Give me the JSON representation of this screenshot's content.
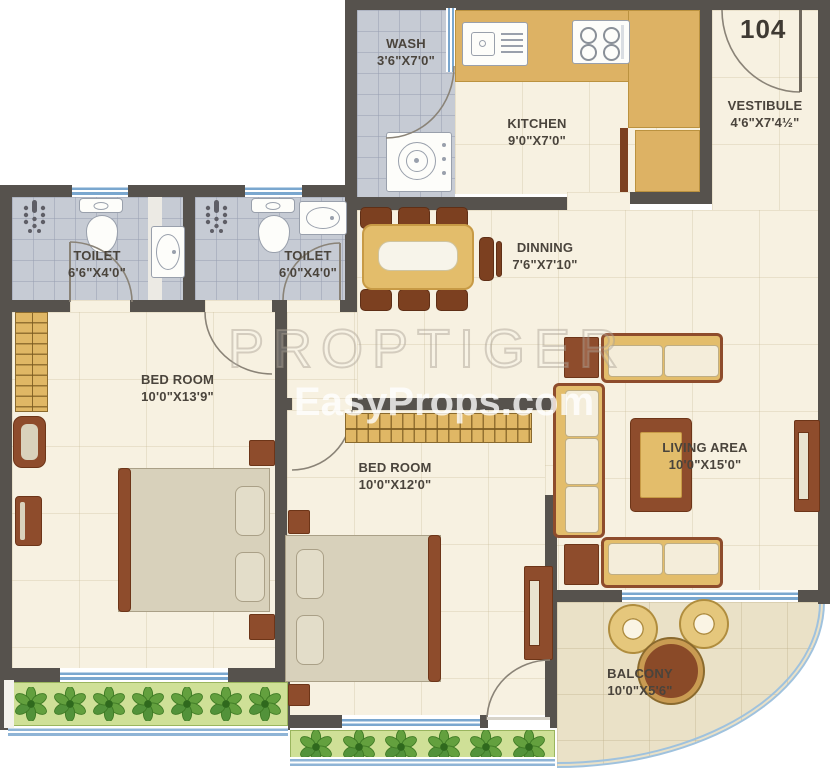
{
  "unit_number": "104",
  "watermarks": {
    "primary": "PROPTIGER",
    "secondary": "EasyProps.com"
  },
  "rooms": {
    "wash": {
      "name": "WASH",
      "dims": "3'6\"X7'0\""
    },
    "kitchen": {
      "name": "KITCHEN",
      "dims": "9'0\"X7'0\""
    },
    "vestibule": {
      "name": "VESTIBULE",
      "dims": "4'6\"X7'4½\""
    },
    "toilet_left": {
      "name": "TOILET",
      "dims": "6'6\"X4'0\""
    },
    "toilet_mid": {
      "name": "TOILET",
      "dims": "6'0\"X4'0\""
    },
    "dining": {
      "name": "DINNING",
      "dims": "7'6\"X7'10\""
    },
    "bedroom_left": {
      "name": "BED ROOM",
      "dims": "10'0\"X13'9\""
    },
    "bedroom_mid": {
      "name": "BED ROOM",
      "dims": "10'0\"X12'0\""
    },
    "living": {
      "name": "LIVING AREA",
      "dims": "10'0\"X15'0\""
    },
    "balcony": {
      "name": "BALCONY",
      "dims": "10'0\"X5'6\""
    }
  },
  "colors": {
    "wall": "#56524d",
    "floor_cream": "#f7f1e1",
    "floor_tile": "#c6cbd4",
    "counter_yellow": "#ddb264",
    "furniture_brown": "#8e4c2c",
    "sofa_cream": "#f4edda",
    "planter_green": "#cfe097",
    "plant_green": "#5d9a3b",
    "window_blue": "#7aa7cf",
    "balcony_floor": "#eae1c7",
    "label_text": "#4a443c"
  }
}
